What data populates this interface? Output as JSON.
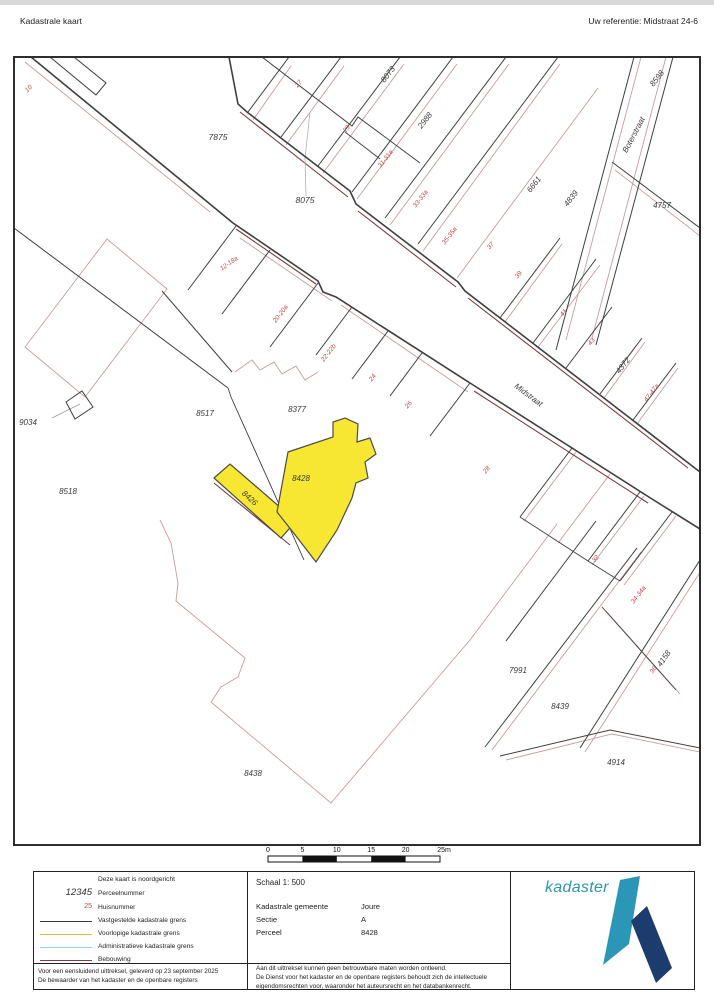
{
  "page": {
    "title_left": "Kadastrale kaart",
    "title_right": "Uw referentie: Midstraat 24-6"
  },
  "map": {
    "highlight_parcel": "8428",
    "highlight_color": "#f7e733",
    "street_labels": [
      {
        "text": "Midstraat",
        "x": 527,
        "y": 397,
        "rot": 37
      },
      {
        "text": "Boterstraat",
        "x": 636,
        "y": 136,
        "rot": -62
      }
    ],
    "parcel_labels": [
      {
        "text": "7875",
        "x": 218,
        "y": 140,
        "rot": 0,
        "big": true
      },
      {
        "text": "8075",
        "x": 305,
        "y": 203,
        "rot": 0,
        "big": true
      },
      {
        "text": "8073",
        "x": 390,
        "y": 76,
        "rot": -52
      },
      {
        "text": "2988",
        "x": 427,
        "y": 122,
        "rot": -52
      },
      {
        "text": "8598",
        "x": 659,
        "y": 80,
        "rot": -52
      },
      {
        "text": "4757",
        "x": 662,
        "y": 208,
        "rot": 0
      },
      {
        "text": "6661",
        "x": 536,
        "y": 186,
        "rot": -52
      },
      {
        "text": "4839",
        "x": 573,
        "y": 200,
        "rot": -52
      },
      {
        "text": "4372",
        "x": 625,
        "y": 367,
        "rot": -52
      },
      {
        "text": "9034",
        "x": 28,
        "y": 425,
        "rot": 0
      },
      {
        "text": "8518",
        "x": 68,
        "y": 494,
        "rot": 0
      },
      {
        "text": "8517",
        "x": 205,
        "y": 416,
        "rot": 0
      },
      {
        "text": "8377",
        "x": 297,
        "y": 412,
        "rot": 0
      },
      {
        "text": "8428",
        "x": 301,
        "y": 481,
        "rot": 0
      },
      {
        "text": "8426",
        "x": 248,
        "y": 500,
        "rot": 42
      },
      {
        "text": "7991",
        "x": 518,
        "y": 673,
        "rot": 0
      },
      {
        "text": "8439",
        "x": 560,
        "y": 709,
        "rot": 0
      },
      {
        "text": "4914",
        "x": 616,
        "y": 765,
        "rot": 0
      },
      {
        "text": "4158",
        "x": 666,
        "y": 660,
        "rot": -55
      },
      {
        "text": "8438",
        "x": 253,
        "y": 776,
        "rot": 0
      }
    ],
    "house_numbers": [
      {
        "text": "10",
        "x": 30,
        "y": 90,
        "rot": -45
      },
      {
        "text": "25",
        "x": 263,
        "y": 54,
        "rot": -50
      },
      {
        "text": "27",
        "x": 300,
        "y": 85,
        "rot": -50
      },
      {
        "text": "29",
        "x": 348,
        "y": 130,
        "rot": -50
      },
      {
        "text": "31-31a",
        "x": 387,
        "y": 160,
        "rot": -52
      },
      {
        "text": "33-33a",
        "x": 422,
        "y": 200,
        "rot": -52
      },
      {
        "text": "35-35a",
        "x": 451,
        "y": 237,
        "rot": -52
      },
      {
        "text": "37",
        "x": 492,
        "y": 247,
        "rot": -50
      },
      {
        "text": "39",
        "x": 520,
        "y": 276,
        "rot": -50
      },
      {
        "text": "41",
        "x": 565,
        "y": 314,
        "rot": -50
      },
      {
        "text": "43",
        "x": 593,
        "y": 343,
        "rot": -50
      },
      {
        "text": "47-47a",
        "x": 653,
        "y": 394,
        "rot": -52
      },
      {
        "text": "12-18a",
        "x": 230,
        "y": 265,
        "rot": -35
      },
      {
        "text": "20-20a",
        "x": 282,
        "y": 315,
        "rot": -52
      },
      {
        "text": "22-22b",
        "x": 330,
        "y": 354,
        "rot": -52
      },
      {
        "text": "24",
        "x": 374,
        "y": 379,
        "rot": -50
      },
      {
        "text": "26",
        "x": 410,
        "y": 406,
        "rot": -50
      },
      {
        "text": "28",
        "x": 488,
        "y": 471,
        "rot": -50
      },
      {
        "text": "32",
        "x": 597,
        "y": 560,
        "rot": -50
      },
      {
        "text": "34-34a",
        "x": 640,
        "y": 596,
        "rot": -52
      },
      {
        "text": "36",
        "x": 655,
        "y": 671,
        "rot": -55
      }
    ]
  },
  "scalebar": {
    "labels": [
      "0",
      "5",
      "10",
      "15",
      "20",
      "25m"
    ]
  },
  "legend": {
    "north_note": "Deze kaart is noordgericht",
    "sample_parcel": "12345",
    "sample_house": "25",
    "items": [
      {
        "label": "Perceelnummer"
      },
      {
        "label": "Huisnummer"
      },
      {
        "label": "Vastgestelde kadastrale grens",
        "color": "#3a3a3a"
      },
      {
        "label": "Voorlopige kadastrale grens",
        "color": "#cfc23a"
      },
      {
        "label": "Administratieve kadastrale grens",
        "color": "#8ed6e4"
      },
      {
        "label": "Bebouwing",
        "color": "#8b3a3a"
      }
    ],
    "footer_lines": [
      "Voor een eensluidend uittreksel, geleverd op 23 september 2025",
      "De bewaarder van het kadaster en de openbare registers"
    ]
  },
  "info": {
    "schaal": "Schaal 1: 500",
    "rows": [
      {
        "label": "Kadastrale gemeente",
        "value": "Joure"
      },
      {
        "label": "Sectie",
        "value": "A"
      },
      {
        "label": "Perceel",
        "value": "8428"
      }
    ],
    "note_lines": [
      "Aan dit uittreksel kunnen geen betrouwbare maten worden ontleend.",
      "De Dienst voor het kadaster en de openbare registers behoudt zich de intellectuele",
      "eigendomsrechten voor, waaronder het auteursrecht en het databankenrecht."
    ]
  },
  "logo": {
    "text": "kadaster",
    "teal": "#2b96b5",
    "navy": "#1d3c6e"
  }
}
